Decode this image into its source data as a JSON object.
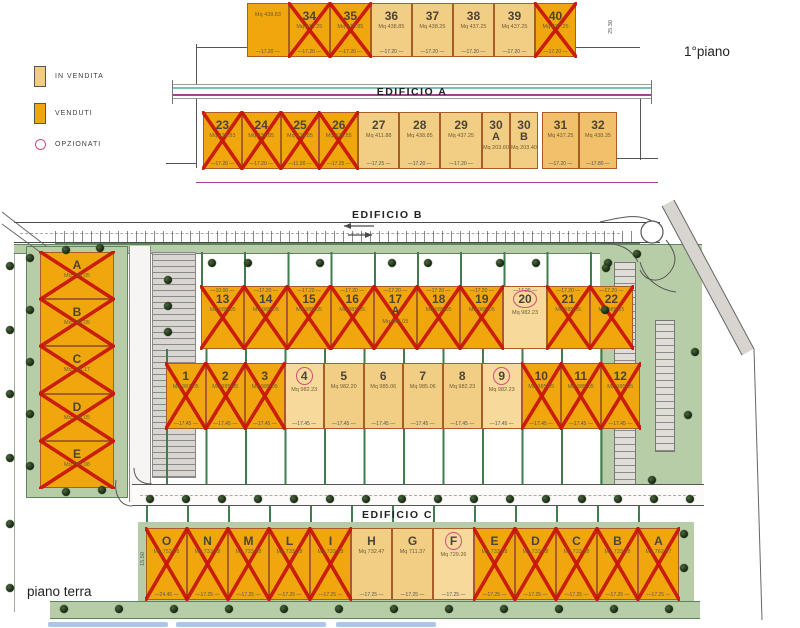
{
  "labels": {
    "floor_top": "1°piano",
    "floor_bottom": "piano terra",
    "edificio_a": "EDIFICIO A",
    "edificio_b": "EDIFICIO B",
    "edificio_c": "EDIFICIO C"
  },
  "legend": {
    "in_vendita": "IN VENDITA",
    "venduti": "VENDUTI",
    "opzionati": "OPZIONATI"
  },
  "colors": {
    "in_vendita": "#f2ce85",
    "venduti": "#f0a70e",
    "cross": "#c9170a",
    "opzione_ring": "#d34f7e",
    "green_strip": "#b7cda8",
    "green_line": "#3f7d4e",
    "road": "#d8d4d0",
    "teal_line": "#7fbfb2",
    "magenta_line": "#a83f96"
  },
  "dims": {
    "c_left": "15.50",
    "a_right": "25.30"
  },
  "edificio_a": {
    "row1": [
      {
        "id": "",
        "mq": "Mq 438.83",
        "status": "venduto",
        "nocross": true,
        "dim": "17.20",
        "w": 1.02
      },
      {
        "id": "34",
        "mq": "Mq 437.25",
        "status": "venduto",
        "dim": "17.20"
      },
      {
        "id": "35",
        "mq": "Mq 438.85",
        "status": "venduto",
        "dim": "17.20"
      },
      {
        "id": "36",
        "mq": "Mq 438.85",
        "status": "in_vendita",
        "dim": "17.20"
      },
      {
        "id": "37",
        "mq": "Mq 438.25",
        "status": "in_vendita",
        "dim": "17.20"
      },
      {
        "id": "38",
        "mq": "Mq 437.25",
        "status": "in_vendita",
        "dim": "17.20"
      },
      {
        "id": "39",
        "mq": "Mq 437.25",
        "status": "in_vendita",
        "dim": "17.20"
      },
      {
        "id": "40",
        "mq": "Mq 437.25",
        "status": "venduto",
        "dim": "17.20"
      }
    ],
    "row2": [
      {
        "id": "23",
        "mq": "Mq 438.83",
        "status": "venduto",
        "dim": "17.20"
      },
      {
        "id": "24",
        "mq": "Mq 438.85",
        "status": "venduto",
        "dim": "17.20"
      },
      {
        "id": "25",
        "mq": "Mq 438.85",
        "status": "venduto",
        "dim": "11.00"
      },
      {
        "id": "26",
        "mq": "Mq 438.85",
        "status": "venduto",
        "dim": "17.25"
      },
      {
        "id": "27",
        "mq": "Mq 411.88",
        "status": "in_vendita",
        "dim": "17.25",
        "w": 1.06
      },
      {
        "id": "28",
        "mq": "Mq 438.85",
        "status": "in_vendita",
        "dim": "17.20",
        "w": 1.06
      },
      {
        "id": "29",
        "mq": "Mq 437.25",
        "status": "in_vendita",
        "dim": "17.20",
        "w": 1.08
      },
      {
        "id": "30",
        "sub": "A",
        "mq": "Mq 203.60",
        "status": "in_vendita",
        "dim": "",
        "w": 0.52
      },
      {
        "id": "30",
        "sub": "B",
        "mq": "Mq 203.40",
        "status": "in_vendita",
        "dim": "",
        "w": 0.52
      },
      {
        "id": "31",
        "mq": "Mq 437.25",
        "status": "in_vendita",
        "variant": "medium",
        "dim": "17.20",
        "w": 0.95,
        "gap": 4
      },
      {
        "id": "32",
        "mq": "Mq 438.35",
        "status": "in_vendita",
        "variant": "medium",
        "dim": "17.80",
        "w": 0.98
      }
    ]
  },
  "edificio_b": {
    "left_column": [
      {
        "id": "A",
        "mq": "Mq 795.05",
        "status": "venduto"
      },
      {
        "id": "B",
        "mq": "Mq 795.05",
        "status": "venduto"
      },
      {
        "id": "C",
        "mq": "Mq 795.17",
        "status": "venduto"
      },
      {
        "id": "D",
        "mq": "Mq 795.05",
        "status": "venduto"
      },
      {
        "id": "E",
        "mq": "Mq 795.08",
        "status": "venduto"
      }
    ],
    "row_upper": [
      {
        "id": "13",
        "mq": "Mq 985.05",
        "status": "venduto",
        "dim": "10.00"
      },
      {
        "id": "14",
        "mq": "Mq 985.05",
        "status": "venduto",
        "dim": "17.20"
      },
      {
        "id": "15",
        "mq": "Mq 985.05",
        "status": "venduto",
        "dim": "17.20"
      },
      {
        "id": "16",
        "mq": "Mq 985.05",
        "status": "venduto",
        "dim": "17.20"
      },
      {
        "id": "17",
        "sub": "A",
        "mq": "Mq 985.05",
        "status": "venduto",
        "dim": "17.20"
      },
      {
        "id": "18",
        "mq": "Mq 985.05",
        "status": "venduto",
        "dim": "17.20"
      },
      {
        "id": "19",
        "mq": "Mq 985.05",
        "status": "venduto",
        "dim": "17.20"
      },
      {
        "id": "20",
        "mq": "Mq 982.23",
        "status": "opzionato",
        "dim": "17.20"
      },
      {
        "id": "21",
        "mq": "Mq 985.05",
        "status": "venduto",
        "dim": "17.20"
      },
      {
        "id": "22",
        "mq": "Mq 985.05",
        "status": "venduto",
        "dim": "17.20"
      }
    ],
    "row_lower": [
      {
        "id": "1",
        "mq": "Mq 987.05",
        "status": "venduto",
        "dim": "17.45"
      },
      {
        "id": "2",
        "mq": "Mq 985.05",
        "status": "venduto",
        "dim": "17.45"
      },
      {
        "id": "3",
        "mq": "Mq 985.05",
        "status": "venduto",
        "dim": "17.45"
      },
      {
        "id": "4",
        "mq": "Mq 982.23",
        "status": "opzionato",
        "dim": "17.45"
      },
      {
        "id": "5",
        "mq": "Mq 982.20",
        "status": "in_vendita",
        "dim": "17.45"
      },
      {
        "id": "6",
        "mq": "Mq 985.06",
        "status": "in_vendita",
        "dim": "17.45"
      },
      {
        "id": "7",
        "mq": "Mq 985.06",
        "status": "in_vendita",
        "dim": "17.45"
      },
      {
        "id": "8",
        "mq": "Mq 982.23",
        "status": "in_vendita",
        "dim": "17.45"
      },
      {
        "id": "9",
        "mq": "Mq 982.23",
        "status": "opzionato",
        "dim": "17.45"
      },
      {
        "id": "10",
        "mq": "Mq 985.05",
        "status": "venduto",
        "dim": "17.45"
      },
      {
        "id": "11",
        "mq": "Mq 985.05",
        "status": "venduto",
        "dim": "17.45"
      },
      {
        "id": "12",
        "mq": "Mq 985.05",
        "status": "venduto",
        "dim": "17.45"
      }
    ]
  },
  "edificio_c": {
    "row": [
      {
        "id": "O",
        "mq": "Mq 753.48",
        "status": "venduto",
        "dim": "24.45"
      },
      {
        "id": "N",
        "mq": "Mq 733.28",
        "status": "venduto",
        "dim": "17.25"
      },
      {
        "id": "M",
        "mq": "Mq 733.28",
        "status": "venduto",
        "dim": "17.25"
      },
      {
        "id": "L",
        "mq": "Mq 733.28",
        "status": "venduto",
        "dim": "17.25"
      },
      {
        "id": "I",
        "mq": "Mq 733.28",
        "status": "venduto",
        "dim": "17.25"
      },
      {
        "id": "H",
        "mq": "Mq 732.47",
        "status": "in_vendita",
        "dim": "17.25"
      },
      {
        "id": "G",
        "mq": "Mq 711.37",
        "status": "in_vendita",
        "dim": "17.25"
      },
      {
        "id": "F",
        "mq": "Mq 729.26",
        "status": "opzionato",
        "dim": "17.25"
      },
      {
        "id": "E",
        "mq": "Mq 733.28",
        "status": "venduto",
        "dim": "17.25"
      },
      {
        "id": "D",
        "mq": "Mq 733.28",
        "status": "venduto",
        "dim": "17.25"
      },
      {
        "id": "C",
        "mq": "Mq 733.28",
        "status": "venduto",
        "dim": "17.25"
      },
      {
        "id": "B",
        "mq": "Mq 733.28",
        "status": "venduto",
        "dim": "17.25"
      },
      {
        "id": "A",
        "mq": "Mq 762.97",
        "status": "venduto",
        "dim": "17.25"
      }
    ]
  },
  "site": {
    "trees": [
      [
        30,
        258
      ],
      [
        30,
        310
      ],
      [
        30,
        362
      ],
      [
        30,
        414
      ],
      [
        30,
        466
      ],
      [
        66,
        250
      ],
      [
        100,
        248
      ],
      [
        66,
        492
      ],
      [
        102,
        490
      ],
      [
        10,
        266
      ],
      [
        10,
        330
      ],
      [
        10,
        394
      ],
      [
        10,
        458
      ],
      [
        10,
        524
      ],
      [
        10,
        588
      ],
      [
        168,
        280
      ],
      [
        168,
        306
      ],
      [
        168,
        332
      ],
      [
        212,
        263
      ],
      [
        248,
        263
      ],
      [
        320,
        263
      ],
      [
        392,
        263
      ],
      [
        428,
        263
      ],
      [
        500,
        263
      ],
      [
        536,
        263
      ],
      [
        608,
        263
      ],
      [
        150,
        499
      ],
      [
        186,
        499
      ],
      [
        222,
        499
      ],
      [
        258,
        499
      ],
      [
        294,
        499
      ],
      [
        330,
        499
      ],
      [
        366,
        499
      ],
      [
        402,
        499
      ],
      [
        438,
        499
      ],
      [
        474,
        499
      ],
      [
        510,
        499
      ],
      [
        546,
        499
      ],
      [
        582,
        499
      ],
      [
        618,
        499
      ],
      [
        654,
        499
      ],
      [
        690,
        499
      ],
      [
        64,
        609
      ],
      [
        119,
        609
      ],
      [
        174,
        609
      ],
      [
        229,
        609
      ],
      [
        284,
        609
      ],
      [
        339,
        609
      ],
      [
        394,
        609
      ],
      [
        449,
        609
      ],
      [
        504,
        609
      ],
      [
        559,
        609
      ],
      [
        614,
        609
      ],
      [
        669,
        609
      ],
      [
        606,
        268
      ],
      [
        605,
        310
      ],
      [
        688,
        415
      ],
      [
        652,
        480
      ],
      [
        695,
        352
      ],
      [
        637,
        254
      ],
      [
        684,
        534
      ],
      [
        684,
        568
      ]
    ]
  }
}
